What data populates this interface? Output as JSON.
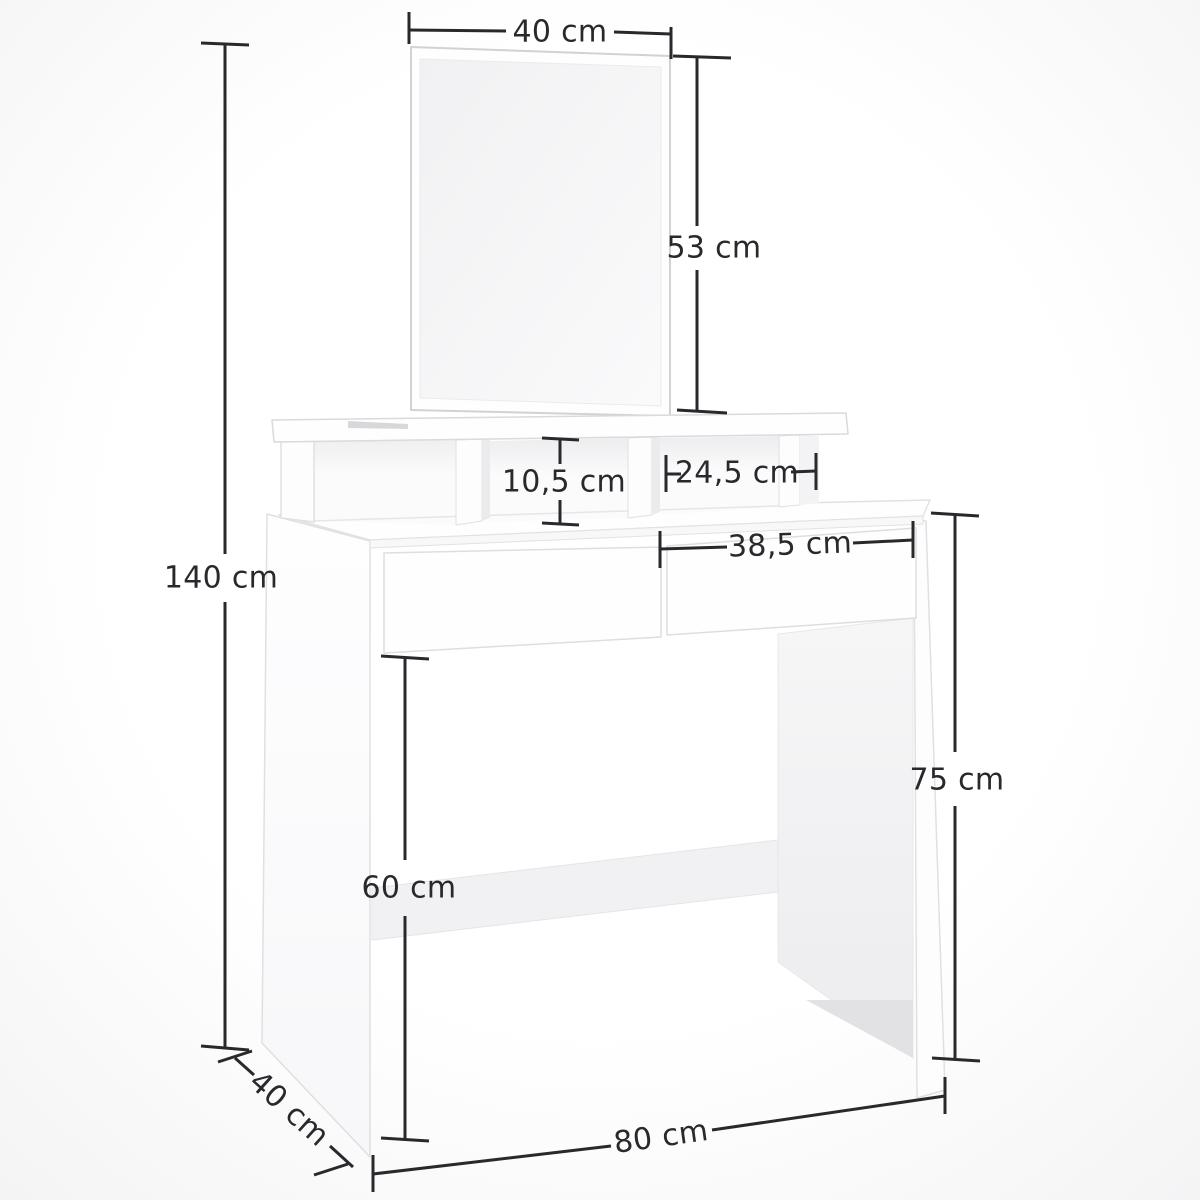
{
  "diagram": {
    "subject": "White dressing table with rectangular mirror, three open organizer compartments, two drawers, side panel legs and a floor stretcher",
    "unit": "cm",
    "style": {
      "line_color": "#29292d",
      "text_color": "#29292d",
      "furniture_edge": "#dedee1",
      "furniture_fill": "#fdfdfe",
      "shade_light": "#f2f2f4",
      "shade_mid": "#ececee",
      "shade_dark": "#e2e2e5",
      "glass": "#f3f3f5",
      "background": "#ffffff"
    },
    "dimensions": [
      {
        "id": "mirror-width",
        "label": "40 cm",
        "measures": "mirror width",
        "orientation": "horizontal"
      },
      {
        "id": "mirror-height",
        "label": "53 cm",
        "measures": "mirror height",
        "orientation": "vertical"
      },
      {
        "id": "compartment-height",
        "label": "10,5 cm",
        "measures": "organizer compartment height",
        "orientation": "vertical"
      },
      {
        "id": "compartment-width",
        "label": "24,5 cm",
        "measures": "right organizer compartment width",
        "orientation": "horizontal"
      },
      {
        "id": "drawer-width",
        "label": "38,5 cm",
        "measures": "drawer front width",
        "orientation": "horizontal"
      },
      {
        "id": "total-height",
        "label": "140 cm",
        "measures": "overall height",
        "orientation": "vertical"
      },
      {
        "id": "table-height",
        "label": "75 cm",
        "measures": "height to tabletop",
        "orientation": "vertical"
      },
      {
        "id": "legroom-height",
        "label": "60 cm",
        "measures": "legroom height under drawers",
        "orientation": "vertical"
      },
      {
        "id": "depth",
        "label": "40 cm",
        "measures": "table depth",
        "orientation": "diagonal"
      },
      {
        "id": "width",
        "label": "80 cm",
        "measures": "overall width",
        "orientation": "horizontal"
      }
    ]
  }
}
